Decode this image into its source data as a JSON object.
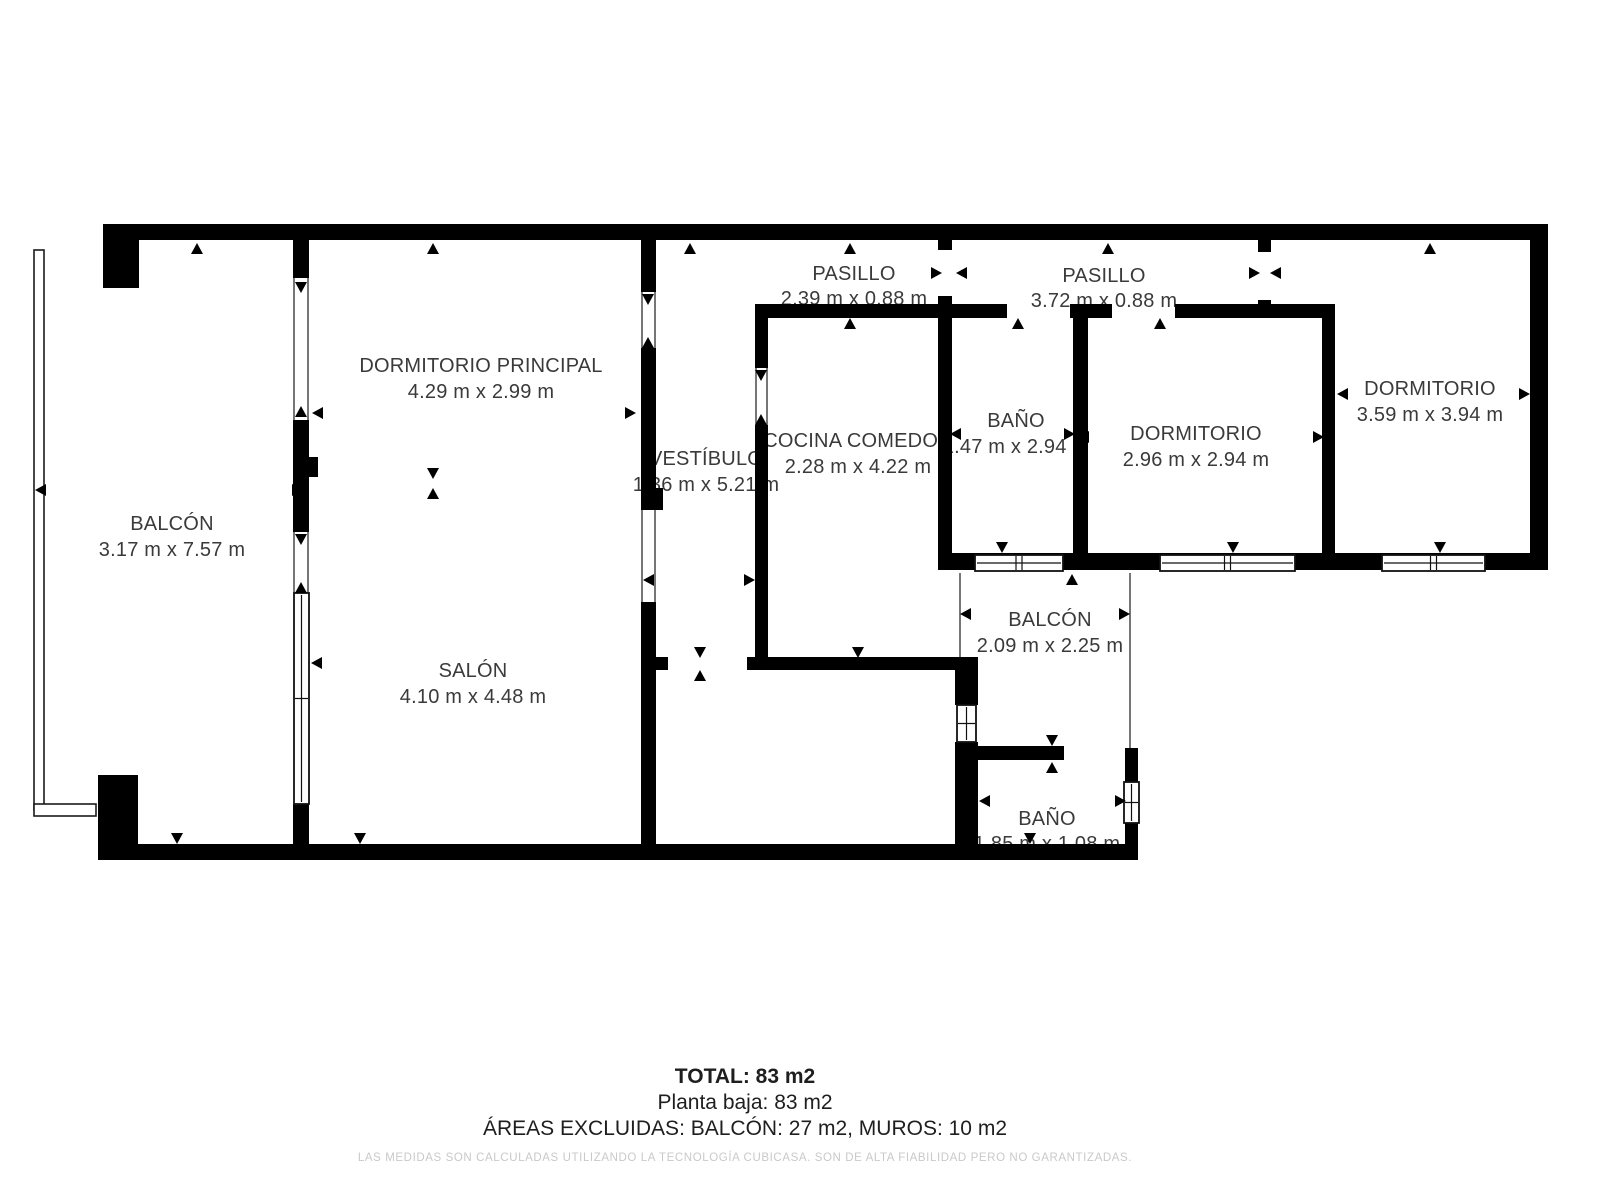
{
  "colors": {
    "wall": "#000000",
    "room_label": "#3a3a3a",
    "summary_text": "#1e1e1e",
    "disclaimer_text": "#c9c9c9",
    "background": "#ffffff"
  },
  "rooms": [
    {
      "name": "BALCÓN",
      "dims": "3.17 m x 7.57 m"
    },
    {
      "name": "DORMITORIO PRINCIPAL",
      "dims": "4.29 m x 2.99 m"
    },
    {
      "name": "SALÓN",
      "dims": "4.10 m x 4.48 m"
    },
    {
      "name": "VESTÍBULO",
      "dims": "1.36 m x 5.21 m"
    },
    {
      "name": "PASILLO",
      "dims": "2.39 m x 0.88 m"
    },
    {
      "name": "COCINA COMEDOR",
      "dims": "2.28 m x 4.22 m"
    },
    {
      "name": "PASILLO",
      "dims": "3.72 m x 0.88 m"
    },
    {
      "name": "BAÑO",
      "dims": "1.47 m x 2.94 m"
    },
    {
      "name": "DORMITORIO",
      "dims": "2.96 m x 2.94 m"
    },
    {
      "name": "DORMITORIO",
      "dims": "3.59 m x 3.94 m"
    },
    {
      "name": "BALCÓN",
      "dims": "2.09 m x 2.25 m"
    },
    {
      "name": "BAÑO",
      "dims": "1.85 m x 1.08 m"
    }
  ],
  "summary": {
    "total": "TOTAL: 83 m2",
    "floor": "Planta baja: 83 m2",
    "excluded": "ÁREAS EXCLUIDAS: BALCÓN: 27 m2, MUROS: 10 m2",
    "disclaimer": "LAS MEDIDAS SON CALCULADAS UTILIZANDO LA TECNOLOGÍA CUBICASA. SON DE ALTA FIABILIDAD PERO NO GARANTIZADAS."
  }
}
